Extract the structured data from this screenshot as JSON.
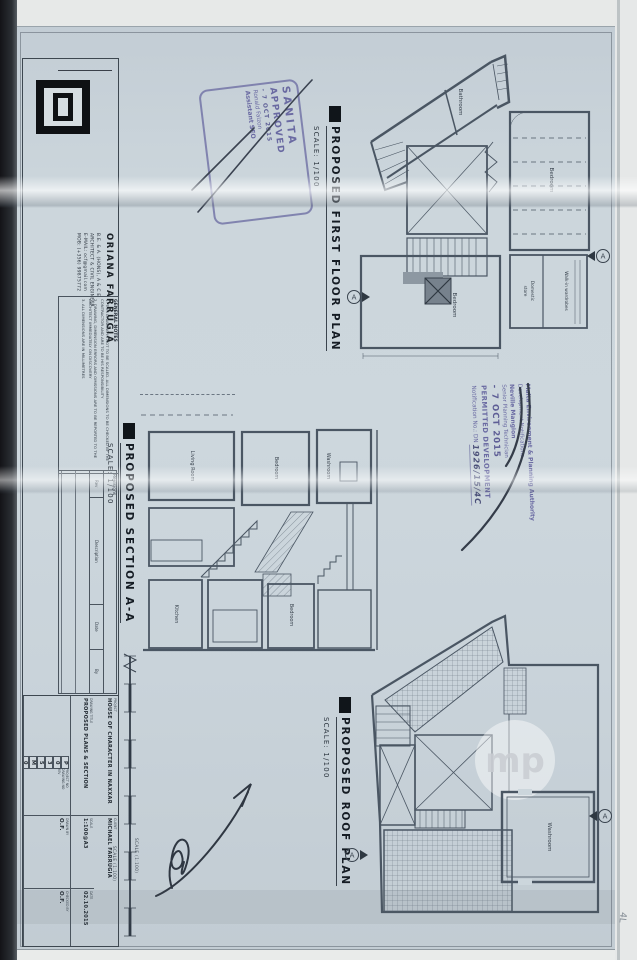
{
  "colors": {
    "paper": "#ccd6dc",
    "ink": "#4a5663",
    "stamp_ink": "#6a6aa2",
    "title_ink": "#151c24",
    "logo_black": "#0f1114"
  },
  "architect_block": {
    "name": "ORIANA FARRUGIA",
    "credentials": "B.E. & A. (HONS), A & C E",
    "profession": "ARCHITECT & CIVIL ENGINEER",
    "email": "E-MAIL: ocf@gmail.com",
    "mobile": "MOB: (+356) 99875772"
  },
  "general_notes": {
    "heading": "GENERAL NOTES",
    "note1": "1. THIS DRAWING IS NOT TO BE SCALED. ALL DIMENSIONS TO BE CHECKED BY THE CONTRACTOR AND ARE TO BE HIS RESPONSIBILITY",
    "note2": "2. DRAWING, DIMENSION ERRORS AND OMISSIONS ARE TO BE REPORTED TO THE ARCHITECT IMMEDIATELY ON DISCOVERY",
    "note3": "3. ALL DIMENSIONS ARE IN MILLIMETRES"
  },
  "revisions": {
    "heading": "Revisions",
    "col_rev": "Rev",
    "col_description": "Description",
    "col_date": "Date",
    "col_by": "By"
  },
  "project_info": {
    "project_label": "PROJECT",
    "project": "HOUSE OF CHARACTER IN NAXXAR",
    "client_label": "CLIENT",
    "client": "MICHAEL FARRUGIA",
    "drawing_title_label": "DRAWING TITLE",
    "drawing_title": "PROPOSED PLANS & SECTION",
    "scale_label": "SCALE",
    "scale": "1:100@A3",
    "date_label": "DATE",
    "date": "02.10.2015",
    "project_no_label": "PROJECT NO",
    "drawing_no_label": "DRAWING NO",
    "rev_label": "REV",
    "number_boxes": [
      "P",
      "0",
      "3",
      "5",
      "M",
      "0",
      "0",
      "2",
      "-"
    ],
    "drawn_by_label": "DRAWN BY",
    "drawn_by": "O.F.",
    "checked_by_label": "CHECKED BY",
    "checked_by": "O.F."
  },
  "drawings": {
    "section_marker_label": "A",
    "first_floor": {
      "title": "PROPOSED FIRST FLOOR PLAN",
      "scale": "SCALE: 1/100",
      "rooms": {
        "bathroom": "Bathroom",
        "bedroom": "Bedroom",
        "walk_in": "Walk-in wardrobes",
        "domestic_line1": "Domestic",
        "domestic_line2": "store",
        "bedroom2": "Bedroom"
      }
    },
    "section": {
      "title": "PROPOSED SECTION A-A",
      "scale": "SCALE: 1/100",
      "rooms": {
        "living": "Living Room",
        "bedroom": "Bedroom",
        "washroom": "Washroom",
        "kitchen": "Kitchen",
        "bedroom2": "Bedroom"
      }
    },
    "roof": {
      "title": "PROPOSED ROOF PLAN",
      "scale": "SCALE: 1/100",
      "rooms": {
        "washroom": "Washroom"
      }
    }
  },
  "stamps": {
    "sanita": {
      "line1": "SANITA",
      "line2": "APPROVED",
      "date": "- 7 OCT 2015",
      "officer": "Ronald Falzon",
      "role": "Assistant SEO"
    },
    "mepa": {
      "authority": "Malta Environment & Planning Authority",
      "department": "Development Notifications",
      "officer": "Neville Mangion",
      "role": "Senior Planning Technician",
      "date": "- 7 OCT 2015",
      "status": "PERMITTED DEVELOPMENT",
      "notification_label": "Notification No.: DN",
      "notification_number": "1926/15/4C"
    }
  },
  "scale_bar": {
    "label_left": "SCALE (1:100)",
    "label_right": "SCALE (1:100)"
  },
  "watermark": "mp",
  "margin_note": "4L"
}
